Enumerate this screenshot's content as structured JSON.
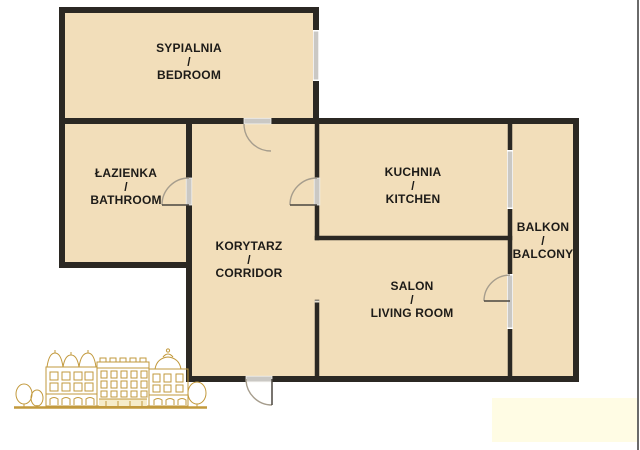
{
  "page": {
    "kind": "apartment-floor-plan",
    "background": "#ffffff"
  },
  "rooms": [
    {
      "id": "bedroom",
      "name_pl": "SYPIALNIA",
      "sep": "/",
      "name_en": "BEDROOM"
    },
    {
      "id": "bathroom",
      "name_pl": "ŁAZIENKA",
      "sep": "/",
      "name_en": "BATHROOM"
    },
    {
      "id": "kitchen",
      "name_pl": "KUCHNIA",
      "sep": "/",
      "name_en": "KITCHEN"
    },
    {
      "id": "corridor",
      "name_pl": "KORYTARZ",
      "sep": "/",
      "name_en": "CORRIDOR"
    },
    {
      "id": "living-room",
      "name_pl": "SALON",
      "sep": "/",
      "name_en": "LIVING ROOM"
    },
    {
      "id": "balcony",
      "name_pl": "BALKON",
      "sep": "/",
      "name_en": "BALCONY"
    }
  ],
  "decor": {
    "building_illustration": "gold-line-drawing-of-historic-tenement-building",
    "watermark_block": "blank-pale-yellow-rectangle"
  },
  "colors": {
    "room_fill": "#f2deba",
    "wall": "#2b2823",
    "window_frame": "#cac8c4",
    "door_arc": "#a69d8d",
    "door_leaf": "#4a463f",
    "label_text": "#1d1b18",
    "illustration_gold": "#c2993c",
    "watermark": "#fffce4"
  }
}
